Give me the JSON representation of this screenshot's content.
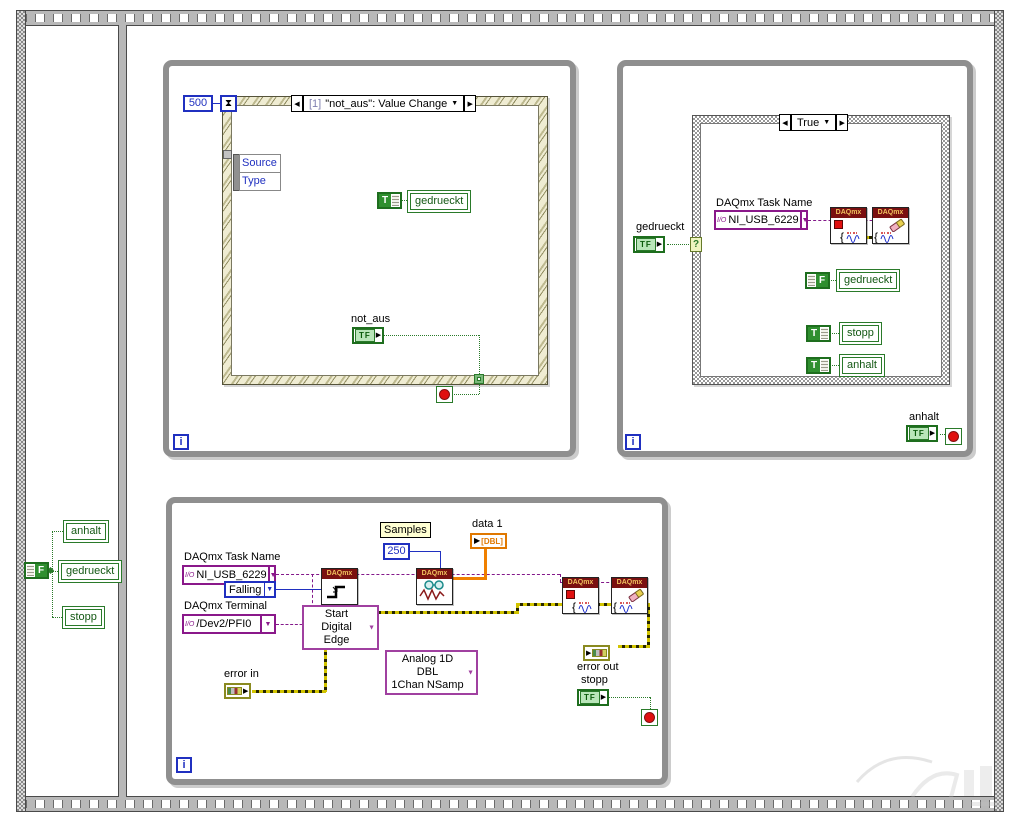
{
  "common": {
    "tf": "TF",
    "t": "T",
    "f": "F",
    "i": "i",
    "daqmx": "DAQmx",
    "question": "?"
  },
  "icons": {
    "dropdown": "▼",
    "prev": "◀",
    "next": "▶",
    "hourglass": "⧗",
    "arrow": "▶"
  },
  "frame0": {
    "locals": {
      "anhalt": "anhalt",
      "gedrueckt": "gedrueckt",
      "stopp": "stopp"
    }
  },
  "loop1": {
    "timeout": "500",
    "event_case": {
      "index": "[1]",
      "title": "\"not_aus\": Value Change"
    },
    "event_node": {
      "row1": "Source",
      "row2": "Type"
    },
    "local_gedrueckt": "gedrueckt",
    "terminal_label": "not_aus"
  },
  "loop2": {
    "case_title": "True",
    "terminal_label": "gedrueckt",
    "task_label": "DAQmx Task Name",
    "task_value": "NI_USB_6229",
    "io_glyph": "I/O",
    "local_gedrueckt": "gedrueckt",
    "local_stopp": "stopp",
    "local_anhalt": "anhalt",
    "anhalt_label": "anhalt"
  },
  "loop3": {
    "task_label": "DAQmx Task Name",
    "task_value": "NI_USB_6229",
    "io_glyph": "I/O",
    "edge_value": "Falling",
    "terminal_label": "DAQmx Terminal",
    "terminal_value": "/Dev2/PFI0",
    "trigger_selector_line1": "Start",
    "trigger_selector_line2": "Digital Edge",
    "read_selector_line1": "Analog 1D DBL",
    "read_selector_line2": "1Chan NSamp",
    "samples_label": "Samples",
    "samples_value": "250",
    "data_label": "data 1",
    "data_type": "[DBL]",
    "error_in_label": "error in",
    "error_out_label": "error out",
    "stopp_label": "stopp"
  }
}
